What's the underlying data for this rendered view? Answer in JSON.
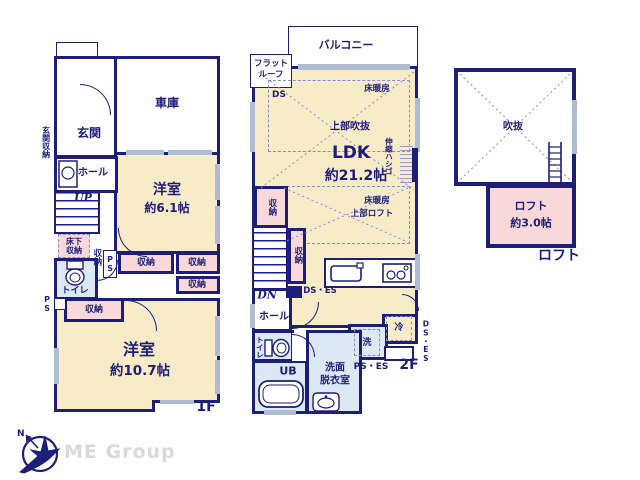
{
  "colors": {
    "wall": "#1d1d7a",
    "cream": "#f8ebc7",
    "pink": "#f8d8d8",
    "blue": "#dde8f5",
    "window": "#b0bcd2",
    "logo_gray": "#d9d9d9",
    "dash": "#8a8ac8"
  },
  "floor1": {
    "label": "1F",
    "garage": "車庫",
    "entrance": "玄関",
    "entrance_storage": "玄関収納",
    "hall": "ホール",
    "up": "UP",
    "underfloor_storage": "床下収納",
    "storage": "収納",
    "ps": "PS",
    "toilet": "トイレ",
    "room1_name": "洋室",
    "room1_size": "約6.1帖",
    "room2_name": "洋室",
    "room2_size": "約10.7帖"
  },
  "floor2": {
    "label": "2F",
    "balcony": "バルコニー",
    "flat_roof_line1": "フラット",
    "flat_roof_line2": "ルーフ",
    "ds": "DS",
    "floor_heating": "床暖房",
    "open_above": "上部吹抜",
    "ldk_name": "LDK",
    "ldk_size": "約21.2帖",
    "ladder": "伸縮ハシゴ",
    "loft_above": "上部ロフト",
    "storage": "収納",
    "dn": "DN",
    "hall": "ホール",
    "toilet": "トイレ",
    "unit_bath": "UB",
    "washroom_line1": "洗面",
    "washroom_line2": "脱衣室",
    "washer": "洗",
    "fridge": "冷",
    "ds_es": "DS・ES",
    "ps_es": "PS・ES"
  },
  "loft": {
    "label": "ロフト",
    "void": "吹抜",
    "name": "ロフト",
    "size": "約3.0帖"
  },
  "logo": {
    "company": "ME Group",
    "north": "N"
  }
}
